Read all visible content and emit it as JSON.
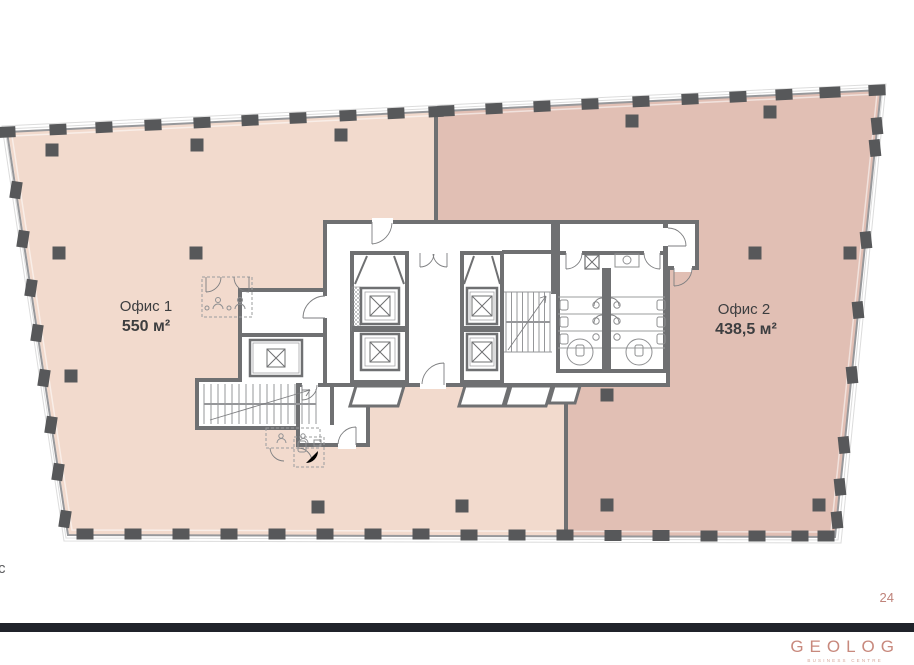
{
  "page": {
    "number": "24",
    "side_text": "с"
  },
  "footer": {
    "logo_text": "GEOLOG",
    "logo_subtitle": "BUSINESS CENTRE"
  },
  "plan": {
    "title": "Floor plan with two office units",
    "offices": [
      {
        "name": "Офис 1",
        "area": "550 м²",
        "fill": "#f2dacd"
      },
      {
        "name": "Офис 2",
        "area": "438,5 м²",
        "fill": "#e1bfb4"
      }
    ],
    "colors": {
      "office1_fill": "#f2dacd",
      "office2_fill": "#e1bfb4",
      "wall": "#6f7072",
      "column": "#57585a",
      "facade_line": "#97989b",
      "accent": "#c8897d",
      "divider_bar": "#20232a"
    }
  }
}
